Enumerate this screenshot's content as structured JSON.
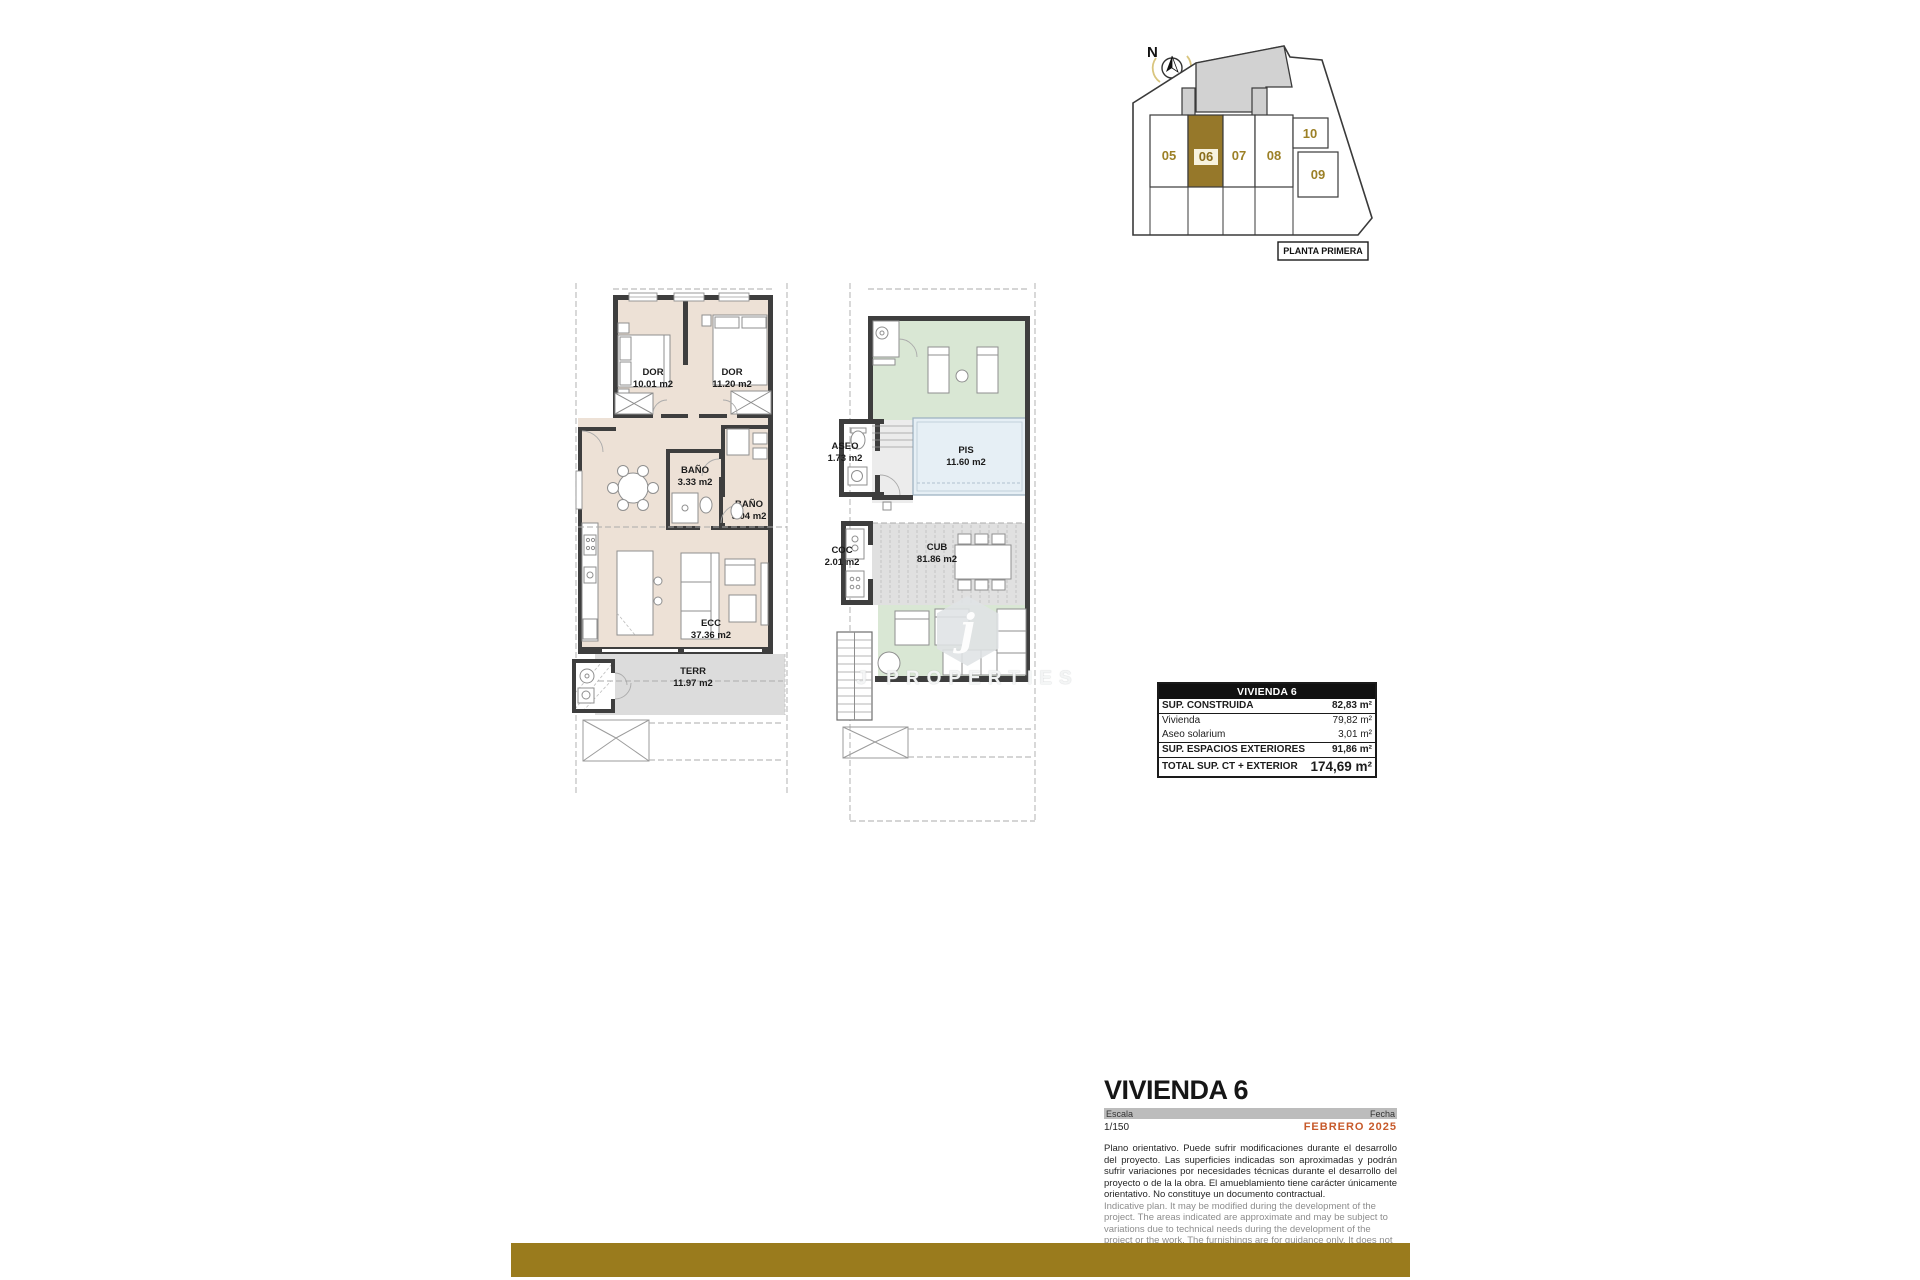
{
  "keyplan": {
    "north": "N",
    "caption": "PLANTA PRIMERA",
    "units": [
      "05",
      "06",
      "07",
      "08",
      "09",
      "10"
    ],
    "highlighted_unit": "06"
  },
  "plan1": {
    "rooms": {
      "dor1": {
        "name": "DOR",
        "area": "10.01 m2"
      },
      "dor2": {
        "name": "DOR",
        "area": "11.20 m2"
      },
      "bano1": {
        "name": "BAÑO",
        "area": "3.33 m2"
      },
      "bano2": {
        "name": "BAÑO",
        "area": "5.04 m2"
      },
      "ecc": {
        "name": "ECC",
        "area": "37.36 m2"
      },
      "terr": {
        "name": "TERR",
        "area": "11.97 m2"
      }
    }
  },
  "plan2": {
    "rooms": {
      "aseo": {
        "name": "ASEO",
        "area": "1.73 m2"
      },
      "pis": {
        "name": "PIS",
        "area": "11.60 m2"
      },
      "coc": {
        "name": "COC",
        "area": "2.01 m2"
      },
      "cub": {
        "name": "CUB",
        "area": "81.86 m2"
      }
    }
  },
  "watermark": {
    "initial": "j",
    "name": "J PROPERTIES"
  },
  "area_table": {
    "header": "VIVIENDA 6",
    "rows": [
      {
        "label": "SUP. CONSTRUIDA",
        "value": "82,83 m²"
      },
      {
        "label": "Vivienda",
        "value": "79,82 m²"
      },
      {
        "label": "Aseo solarium",
        "value": "3,01 m²"
      },
      {
        "label": "SUP. ESPACIOS EXTERIORES",
        "value": "91,86 m²"
      },
      {
        "label": "TOTAL SUP. CT + EXTERIOR",
        "value": "174,69 m²"
      }
    ]
  },
  "titleblock": {
    "title": "VIVIENDA 6",
    "scale_label": "Escala",
    "scale_value": "1/150",
    "date_label": "Fecha",
    "date_value": "FEBRERO 2025",
    "disclaimer_es": "Plano orientativo. Puede sufrir modificaciones durante el desarrollo del proyecto. Las superficies indicadas son aproximadas y podrán sufrir variaciones por necesidades técnicas durante el desarrollo del proyecto o de la la obra. El amueblamiento tiene carácter únicamente orientativo. No constituye un documento contractual.",
    "disclaimer_en": "Indicative plan. It may be modified during the development of the project. The areas indicated are approximate and may be subject to variations due to technical needs during the development of the project or the work. The furnishings are for guidance only. It does not constitute a contractual document."
  },
  "colors": {
    "accent_gold": "#9A7B1D",
    "unit_highlight": "#96782A",
    "date_orange": "#C75A2B",
    "floor_beige": "#EDE1D6",
    "deck_green": "#D9E7D4",
    "pool_blue": "#E6EFF5"
  }
}
